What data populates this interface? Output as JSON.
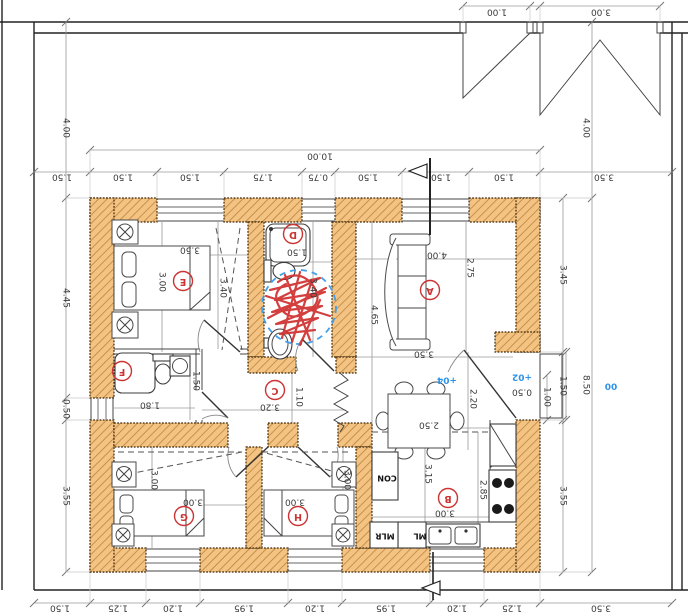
{
  "drawing": {
    "kind": "architectural ground-floor plan with site boundary and gates",
    "note": "all annotation text is rotated 180 degrees (plan viewed upside-down)",
    "units": "meters"
  },
  "colors": {
    "wall_fill": "#f2c382",
    "wall_hatch": "#bd7f35",
    "wall_edge": "#3f2708",
    "dim_text": "#3a3a3a",
    "elevation_blue": "#2e93e8",
    "room_label_red": "#cc3333",
    "scribble_red": "#d02f2f",
    "markup_circle_blue": "#44a0e8"
  },
  "rooms": [
    {
      "id": "A",
      "x": 430,
      "y": 290
    },
    {
      "id": "B",
      "x": 448,
      "y": 498
    },
    {
      "id": "C",
      "x": 275,
      "y": 390
    },
    {
      "id": "D",
      "x": 293,
      "y": 234
    },
    {
      "id": "E",
      "x": 183,
      "y": 281
    },
    {
      "id": "F",
      "x": 122,
      "y": 371
    },
    {
      "id": "G",
      "x": 184,
      "y": 516
    },
    {
      "id": "H",
      "x": 298,
      "y": 516
    }
  ],
  "annotations": [
    {
      "n": "dim-gate-small",
      "t": "1.00",
      "x": 497,
      "y": 12,
      "r": 180
    },
    {
      "n": "dim-gate-large",
      "t": "3.00",
      "x": 601,
      "y": 12,
      "r": 180
    },
    {
      "n": "dim-total-width",
      "t": "10.00",
      "x": 320,
      "y": 156,
      "r": 180
    },
    {
      "n": "dim-top-offset-left",
      "t": "1.50",
      "x": 62,
      "y": 177,
      "r": 180
    },
    {
      "n": "dim-top-1",
      "t": "1.50",
      "x": 123,
      "y": 177,
      "r": 180
    },
    {
      "n": "dim-top-2",
      "t": "1.50",
      "x": 190,
      "y": 177,
      "r": 180
    },
    {
      "n": "dim-top-3",
      "t": "1.75",
      "x": 263,
      "y": 177,
      "r": 180
    },
    {
      "n": "dim-top-4",
      "t": "0.75",
      "x": 318,
      "y": 177,
      "r": 180
    },
    {
      "n": "dim-top-5",
      "t": "1.50",
      "x": 368,
      "y": 177,
      "r": 180
    },
    {
      "n": "dim-top-6",
      "t": "1.50",
      "x": 441,
      "y": 177,
      "r": 180
    },
    {
      "n": "dim-top-7",
      "t": "1.50",
      "x": 504,
      "y": 177,
      "r": 180
    },
    {
      "n": "dim-top-offset-right",
      "t": "3.50",
      "x": 604,
      "y": 177,
      "r": 180
    },
    {
      "n": "dim-left-setback",
      "t": "4.00",
      "x": 66,
      "y": 128,
      "r": 90
    },
    {
      "n": "dim-left-1",
      "t": "4.45",
      "x": 66,
      "y": 298,
      "r": 90
    },
    {
      "n": "dim-left-2",
      "t": "0.50",
      "x": 66,
      "y": 409,
      "r": 90
    },
    {
      "n": "dim-left-3",
      "t": "3.55",
      "x": 66,
      "y": 496,
      "r": 90
    },
    {
      "n": "dim-right-setback",
      "t": "4.00",
      "x": 586,
      "y": 128,
      "r": 90
    },
    {
      "n": "dim-right-1",
      "t": "3.45",
      "x": 563,
      "y": 275,
      "r": 90
    },
    {
      "n": "dim-right-2",
      "t": "1.50",
      "x": 563,
      "y": 386,
      "r": 90
    },
    {
      "n": "dim-right-3",
      "t": "3.55",
      "x": 563,
      "y": 496,
      "r": 90
    },
    {
      "n": "dim-right-total",
      "t": "8.50",
      "x": 586,
      "y": 385,
      "r": 90
    },
    {
      "n": "dim-entry-door",
      "t": "1.00",
      "x": 547,
      "y": 397,
      "r": 90
    },
    {
      "n": "dim-entry-step",
      "t": "0.50",
      "x": 522,
      "y": 392,
      "r": 180
    },
    {
      "n": "dim-hall-door",
      "t": "2.20",
      "x": 473,
      "y": 399,
      "r": 90
    },
    {
      "n": "dim-bottom-offset-left",
      "t": "1.50",
      "x": 60,
      "y": 608,
      "r": 180
    },
    {
      "n": "dim-bottom-1",
      "t": "1.25",
      "x": 118,
      "y": 608,
      "r": 180
    },
    {
      "n": "dim-bottom-2",
      "t": "1.20",
      "x": 173,
      "y": 608,
      "r": 180
    },
    {
      "n": "dim-bottom-3",
      "t": "1.95",
      "x": 244,
      "y": 608,
      "r": 180
    },
    {
      "n": "dim-bottom-4",
      "t": "1.20",
      "x": 315,
      "y": 608,
      "r": 180
    },
    {
      "n": "dim-bottom-5",
      "t": "1.95",
      "x": 386,
      "y": 608,
      "r": 180
    },
    {
      "n": "dim-bottom-6",
      "t": "1.20",
      "x": 457,
      "y": 608,
      "r": 180
    },
    {
      "n": "dim-bottom-7",
      "t": "1.25",
      "x": 512,
      "y": 608,
      "r": 180
    },
    {
      "n": "dim-bottom-offset-right",
      "t": "3.50",
      "x": 601,
      "y": 608,
      "r": 180
    },
    {
      "n": "dim-room-e-width",
      "t": "3.50",
      "x": 190,
      "y": 250,
      "r": 180
    },
    {
      "n": "dim-room-e-depth",
      "t": "3.00",
      "x": 162,
      "y": 282,
      "r": 90
    },
    {
      "n": "dim-closet-strip",
      "t": "3.40",
      "x": 223,
      "y": 288,
      "r": 90
    },
    {
      "n": "dim-room-d-width",
      "t": "1.50",
      "x": 297,
      "y": 252,
      "r": 180
    },
    {
      "n": "dim-room-d-depth",
      "t": "3.40",
      "x": 313,
      "y": 288,
      "r": 90
    },
    {
      "n": "dim-room-a-left",
      "t": "4.65",
      "x": 374,
      "y": 315,
      "r": 90
    },
    {
      "n": "dim-room-a-width",
      "t": "4.00",
      "x": 437,
      "y": 255,
      "r": 180
    },
    {
      "n": "dim-room-a-right",
      "t": "2.75",
      "x": 470,
      "y": 268,
      "r": 90
    },
    {
      "n": "dim-room-a-lower",
      "t": "3.50",
      "x": 424,
      "y": 354,
      "r": 180
    },
    {
      "n": "dim-dining-table",
      "t": "2.50",
      "x": 429,
      "y": 425,
      "r": 180
    },
    {
      "n": "dim-kitchen-depth",
      "t": "3.15",
      "x": 428,
      "y": 474,
      "r": 90
    },
    {
      "n": "dim-kitchen-right",
      "t": "2.85",
      "x": 483,
      "y": 490,
      "r": 90
    },
    {
      "n": "dim-kitchen-width",
      "t": "3.00",
      "x": 445,
      "y": 513,
      "r": 180
    },
    {
      "n": "dim-corridor-width",
      "t": "3.20",
      "x": 270,
      "y": 407,
      "r": 180
    },
    {
      "n": "dim-corridor-depth",
      "t": "1.10",
      "x": 299,
      "y": 397,
      "r": 90
    },
    {
      "n": "dim-wc-width",
      "t": "1.80",
      "x": 150,
      "y": 405,
      "r": 180
    },
    {
      "n": "dim-wc-depth",
      "t": "1.50",
      "x": 196,
      "y": 381,
      "r": 90
    },
    {
      "n": "dim-room-g-width",
      "t": "3.00",
      "x": 193,
      "y": 502,
      "r": 180
    },
    {
      "n": "dim-room-g-depth",
      "t": "3.00",
      "x": 154,
      "y": 480,
      "r": 90
    },
    {
      "n": "dim-room-h-width",
      "t": "3.00",
      "x": 295,
      "y": 502,
      "r": 180
    },
    {
      "n": "dim-room-h-depth",
      "t": "3.00",
      "x": 347,
      "y": 480,
      "r": 90
    },
    {
      "n": "elevation-entry-step",
      "t": "+02",
      "x": 522,
      "y": 377,
      "r": 180,
      "c": "blue"
    },
    {
      "n": "elevation-interior",
      "t": "+04",
      "x": 447,
      "y": 380,
      "r": 180,
      "c": "blue"
    },
    {
      "n": "elevation-site",
      "t": "00",
      "x": 611,
      "y": 386,
      "r": 180,
      "c": "blue"
    },
    {
      "n": "appliance-label-con",
      "t": "CON",
      "x": 387,
      "y": 478,
      "r": 180,
      "b": 1
    },
    {
      "n": "appliance-label-mlr",
      "t": "MLR",
      "x": 385,
      "y": 536,
      "r": 180,
      "b": 1
    },
    {
      "n": "appliance-label-ml",
      "t": "ML",
      "x": 420,
      "y": 536,
      "r": 180,
      "b": 1
    }
  ]
}
